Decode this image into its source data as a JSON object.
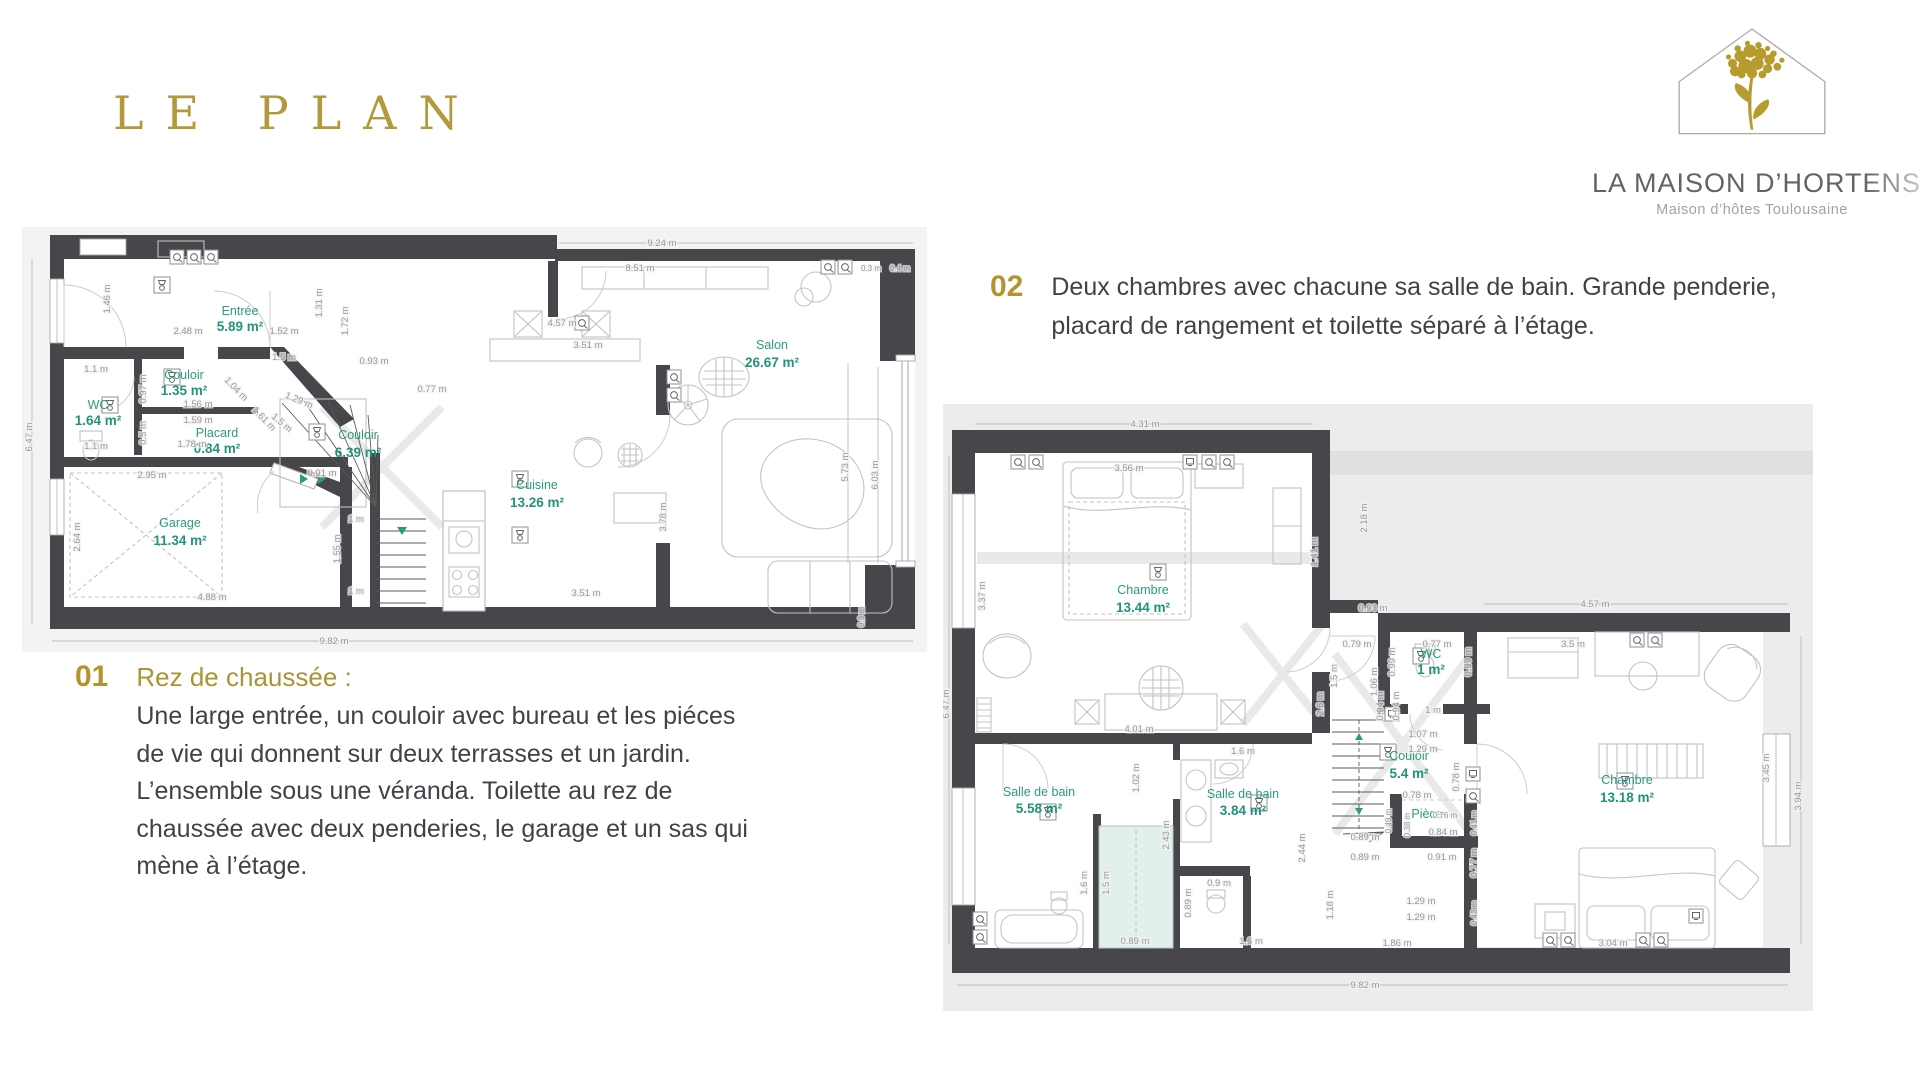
{
  "title": "LE PLAN",
  "logo": {
    "title": "LA MAISON D’HORTENSE",
    "subtitle": "Maison d’hôtes Toulousaine",
    "icon": "house-with-hydrangea-flower"
  },
  "sections": {
    "s01": {
      "number": "01",
      "heading": "Rez de chaussée :",
      "body": "Une large entrée, un couloir avec bureau et les piéces de vie qui donnent sur deux terrasses et un jardin. L’ensemble sous une véranda. Toilette au rez de chaussée avec deux penderies, le garage et un sas qui mène à l’étage."
    },
    "s02": {
      "number": "02",
      "body": "Deux chambres avec chacune sa salle de bain. Grande penderie, placard  de rangement et toilette séparé à l’étage."
    }
  },
  "plan1": {
    "name": "Rez de chaussée — floor plan",
    "rooms": [
      {
        "name": "Entrée",
        "area": "5.89 m²"
      },
      {
        "name": "Salon",
        "area": "26.67 m²"
      },
      {
        "name": "Couloir",
        "area": "1.35 m²"
      },
      {
        "name": "WC",
        "area": "1.64 m²"
      },
      {
        "name": "Placard",
        "area": "0.84 m²"
      },
      {
        "name": "Couloir",
        "area": "6.39 m²"
      },
      {
        "name": "Cuisine",
        "area": "13.26 m²"
      },
      {
        "name": "Garage",
        "area": "11.34 m²"
      }
    ],
    "dims": [
      "9.24 m",
      "8.51 m",
      "0.3 m",
      "0.4 m",
      "6.47 m",
      "1.46 m",
      "2.48 m",
      "1.52 m",
      "1.31 m",
      "1.72 m",
      "1.5 m",
      "1.1 m",
      "0.97 m",
      "1.56 m",
      "1.59 m",
      "0.5 m",
      "1.78 m",
      "1.1 m",
      "1.04 m",
      "1.61 m",
      "0.93 m",
      "0.77 m",
      "4.57 m",
      "3.51 m",
      "2.95 m",
      "1.29 m",
      "1.5 m",
      "0.91 m",
      "1 m",
      "1.55 m",
      "1 m",
      "2.64 m",
      "4.88 m",
      "3.78 m",
      "3.51 m",
      "5.73 m",
      "6.03 m",
      "0.3 m",
      "9.82 m"
    ]
  },
  "plan2": {
    "name": "Étage — floor plan",
    "rooms": [
      {
        "name": "Chambre",
        "area": "13.44 m²"
      },
      {
        "name": "WC",
        "area": "1 m²"
      },
      {
        "name": "Couloir",
        "area": "5.4 m²"
      },
      {
        "name": "Salle de bain",
        "area": "5.58 m²"
      },
      {
        "name": "Salle de bain",
        "area": "3.84 m²"
      },
      {
        "name": "Pièce",
        "area": ""
      },
      {
        "name": "Chambre",
        "area": "13.18 m²"
      }
    ],
    "dims": [
      "4.31 m",
      "3.56 m",
      "2.18 m",
      "1.41 m",
      "6.47 m",
      "3.37 m",
      "0.93 m",
      "0.79 m",
      "0.77 m",
      "0.99 m",
      "0.99 m",
      "1 m",
      "3.5 m",
      "4.57 m",
      "1.5 m",
      "1.06 m",
      "1.07 m",
      "1.29 m",
      "0.94 m",
      "0.94 m",
      "2.6 m",
      "0.78 m",
      "0.78 m",
      "0.76 m",
      "0.84 m",
      "0.38 m",
      "0.41 m",
      "0.49 m",
      "0.89 m",
      "0.89 m",
      "0.91 m",
      "0.77 m",
      "1.29 m",
      "1.29 m",
      "0.42 m",
      "1.86 m",
      "1.18 m",
      "4.01 m",
      "1.02 m",
      "2.43 m",
      "1.6 m",
      "2.44 m",
      "1.6 m",
      "1.5 m",
      "0.9 m",
      "0.89 m",
      "0.89 m",
      "1.6 m",
      "3.45 m",
      "3.94 m",
      "3.04 m",
      "9.82 m"
    ]
  },
  "colors": {
    "gold": "#b2993b",
    "room_label_teal": "#2a9b7e",
    "wall": "#46464b",
    "dimension_gray": "#989898",
    "plan_background": "#ececec"
  }
}
